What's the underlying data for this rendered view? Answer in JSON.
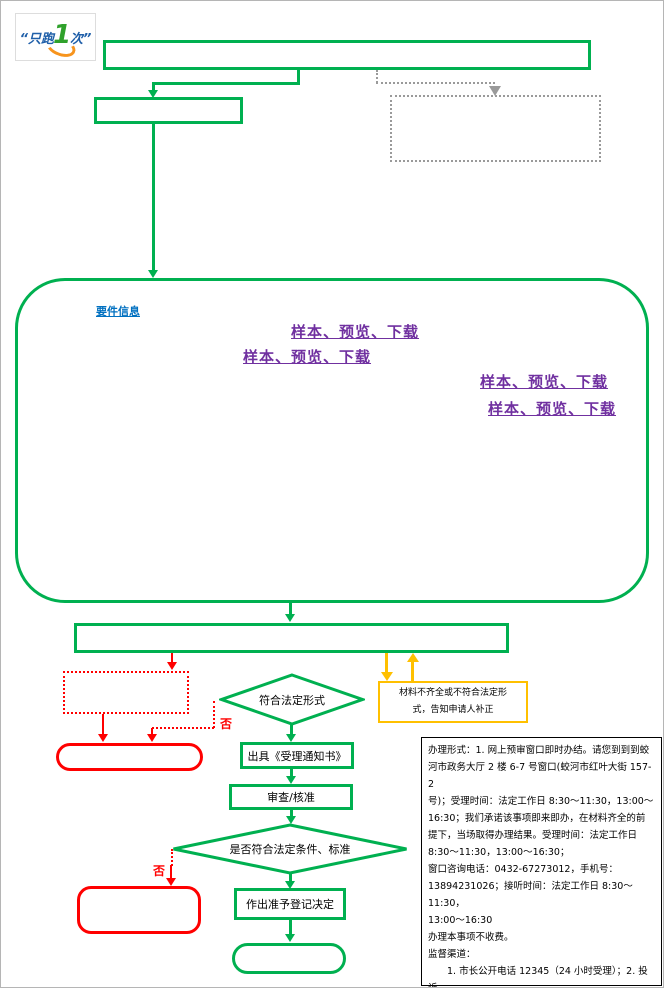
{
  "colors": {
    "green": "#00B050",
    "red": "#FF0000",
    "yellow": "#FFC000",
    "purple": "#7030A0",
    "blue": "#0070C0",
    "gray": "#9a9a9a",
    "text": "#000000"
  },
  "logo": {
    "left": "“只跑",
    "one": "1",
    "right": "次”"
  },
  "panel": {
    "requirements_link": "要件信息",
    "sample_links": [
      "样本、预览、下载",
      "样本、预览、下载",
      "样本、预览、下载",
      "样本、预览、下载"
    ]
  },
  "flow": {
    "diamond_legal_form": "符合法定形式",
    "no_label_first": "否",
    "acceptance_notice": "出具《受理通知书》",
    "review_approve": "审查/核准",
    "diamond_conditions": "是否符合法定条件、标准",
    "no_label_second": "否",
    "grant_registration": "作出准予登记决定",
    "supplement_text": "材料不齐全或不符合法定形\n式，告知申请人补正"
  },
  "info_panel": {
    "text": "办理形式：1. 网上预审窗口即时办结。请您到到到蛟\n河市政务大厅 2 楼 6-7 号窗口(蛟河市红叶大街 157-2\n号)；受理时间：法定工作日 8:30～11:30，13:00～\n16:30；我们承诺该事项即来即办，在材料齐全的前\n提下，当场取得办理结果。受理时间：法定工作日\n8:30～11:30，13:00～16:30；\n窗口咨询电话：0432-67273012，手机号：\n13894231026；接听时间：法定工作日 8:30～11:30，\n13:00～16:30\n办理本事项不收费。\n监督渠道：\n　　1. 市长公开电话 12345（24 小时受理）；2. 投诉\n举报电子邮箱：765758463@163.com  3.. 直接到蛟\n河市政务服务大厅 4 楼协调科进行投诉。"
  }
}
